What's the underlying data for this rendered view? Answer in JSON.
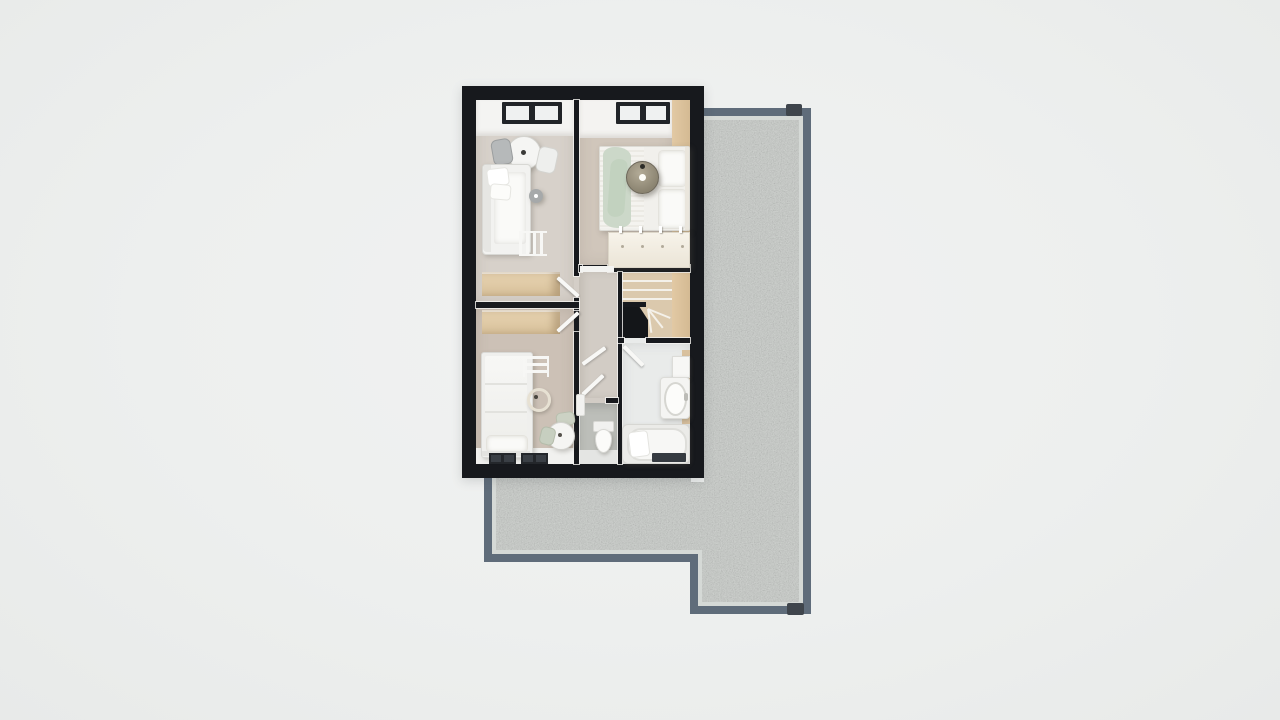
{
  "view": {
    "label": "3d-floor-plan-top-down-render",
    "floor": "upper-floor",
    "background_color": "#edefee"
  },
  "palette": {
    "outer_wall": "#17191d",
    "interior_wall": "#17191d",
    "wood_floor_light": "#d7d1ca",
    "wood_floor_warm": "#ccc1b6",
    "hall_floor": "#d2ccc5",
    "bathroom_floor": "#e9ebea",
    "wc_floor": "#bcbeb9",
    "knee_wall_tan": "#dcc29c",
    "cabinet_tan": "#e0cba8",
    "white_furniture": "#f3f3f1",
    "green_throw": "#ccd8c9",
    "rattan_pendant": "#9a9280",
    "stair_tread": "#dbc9ad",
    "bath_mat": "#363b41",
    "terrace_border": "#5f6c7a",
    "terrace_inner_edge": "#d5d9d6",
    "gravel_base": "#c7cbc7",
    "roof_notch": "#3f454c"
  },
  "house": {
    "shape": "rectangular",
    "rooms": [
      {
        "id": "bedroom-top-left",
        "furniture": [
          "roof-window",
          "bistro-table",
          "chair-gray",
          "chair-white",
          "daybed-sofa",
          "floor-lamp",
          "blanket-ladder",
          "tan-wardrobe"
        ]
      },
      {
        "id": "bedroom-top-right",
        "furniture": [
          "roof-window",
          "double-bed",
          "green-throw-blanket",
          "pillows",
          "rattan-pendant-light",
          "chest-of-drawers"
        ]
      },
      {
        "id": "bedroom-bottom-left",
        "furniture": [
          "tan-wardrobe",
          "single-bed",
          "blanket-ladder",
          "ring-pendant-light",
          "side-table",
          "chairs-sage",
          "roof-window",
          "roof-window"
        ]
      },
      {
        "id": "landing-hallway",
        "furniture": [
          "open-doors",
          "radiator"
        ]
      },
      {
        "id": "staircase",
        "furniture": [
          "winder-stairs",
          "stair-void"
        ]
      },
      {
        "id": "wc",
        "furniture": [
          "toilet"
        ]
      },
      {
        "id": "bathroom",
        "furniture": [
          "wall-cabinet",
          "washbasin-vanity",
          "bathtub",
          "bath-pillow",
          "bath-mat"
        ]
      }
    ]
  },
  "terrace": {
    "surface": "gravel",
    "shape": "L-shaped",
    "border_color": "#5f6c7a",
    "corner_fixtures": 2
  }
}
